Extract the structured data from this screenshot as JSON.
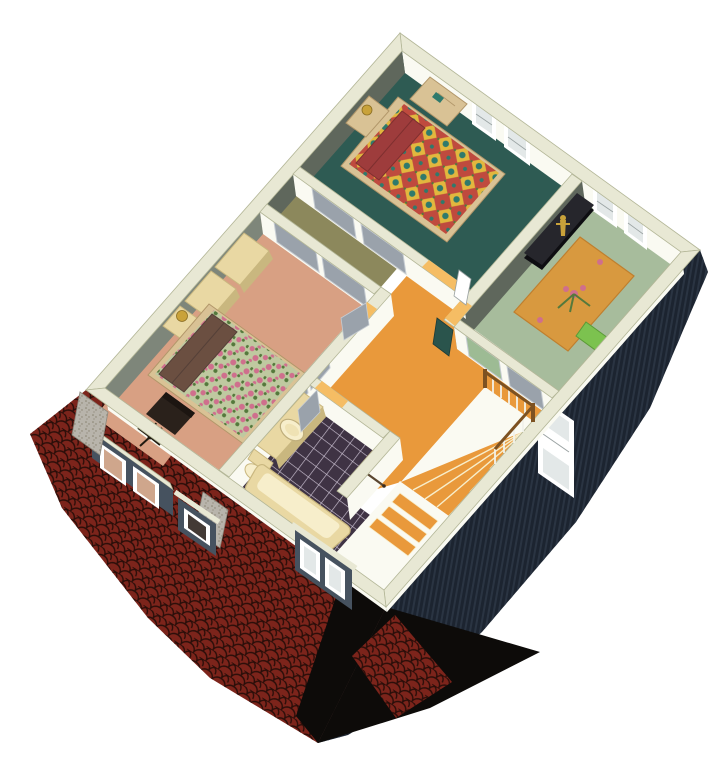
{
  "meta": {
    "title": "Second floor isometric cutaway floor plan rendering",
    "type": "3d-architectural-dollhouse-view",
    "rooms": [
      "bedroom-teal",
      "bedroom-sage",
      "master-bedroom",
      "hallway-stairs",
      "bathroom",
      "closet-corridor"
    ],
    "visible_text": ""
  },
  "colors": {
    "bg": "#ffffff",
    "cap": "#e8e8d4",
    "capEdge": "#b3b697",
    "faceWhite": "#fafaf2",
    "faceGreenDark": "#5f675c",
    "faceGreenLight": "#7e867a",
    "floorTeal": "#2e5b53",
    "floorSage": "#a7bc9c",
    "floorSalmon": "#d8a083",
    "floorWood": "#e9993b",
    "floorWoodLight": "#f5bd64",
    "floorOlive": "#8c885c",
    "tileBase": "#3f3344",
    "tileLine": "#c9bfd0",
    "cream": "#e9d8a3",
    "creamDark": "#c9b77f",
    "creamLight": "#f7eecb",
    "roofRed": "#7c241b",
    "roofLine": "#2a0e09",
    "shadow": "#0d0b09",
    "siding": "#1c2430",
    "sidingStripe": "#2a3442",
    "stone": "#b8b4ab",
    "stoneDot": "#87816f",
    "slate": "#46525f",
    "white": "#ffffff",
    "pane": "#e3e8e8",
    "paneLine": "#9aa2a2",
    "bayPane": "#cfa68c",
    "doorGray": "#9aa2ab",
    "doorGrayEdge": "#c6ccd2",
    "tan": "#d9c295",
    "tanDark": "#b2976a",
    "quiltRed": "#bf4a3e",
    "quiltYellow": "#e2b73e",
    "quiltTeal": "#2f7a6c",
    "floralBase": "#bfc9a0",
    "rose": "#cf6f8d",
    "leaf": "#54793c",
    "maroon": "#9e3c3c",
    "pillowBrown": "#6b4f41",
    "rug": "#d8993f",
    "rugEdge": "#bf7f2e",
    "pillowGreen": "#7cc24f",
    "gold": "#c9a23a",
    "rail": "#7d5222",
    "spindle": "#f2f2ea",
    "chair": "#2a211b",
    "darkTealDoor": "#2a544c",
    "glass": "#433a35",
    "sagePanel": "#9dbb94"
  }
}
